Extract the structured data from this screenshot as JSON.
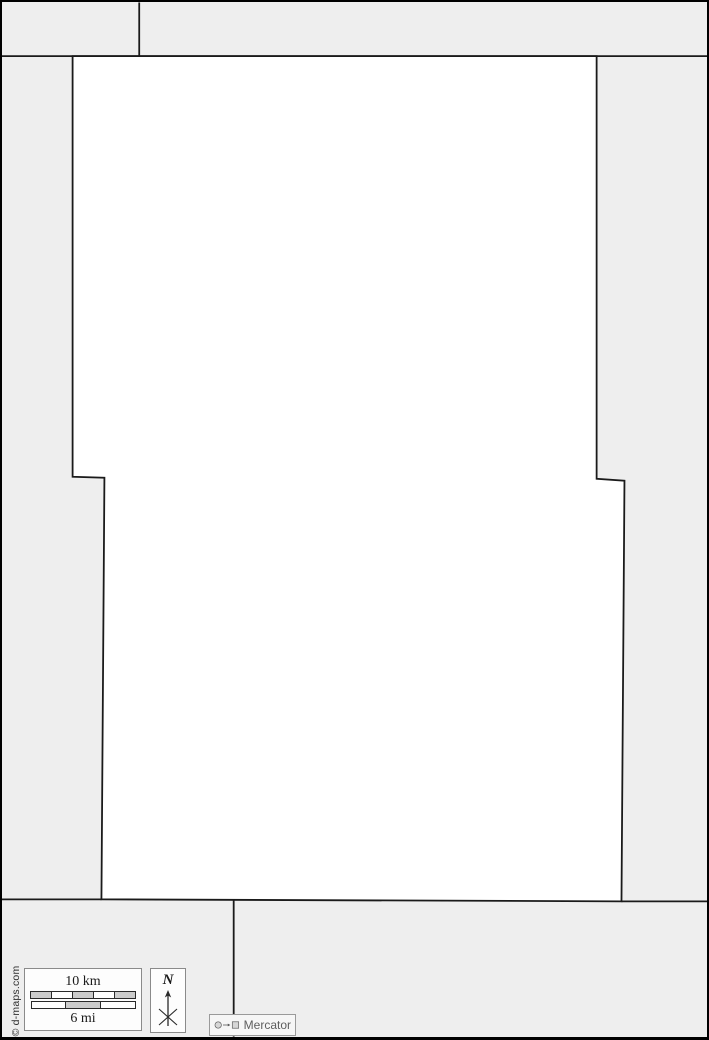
{
  "page": {
    "background_color": "#eeeeee",
    "region_fill": "#ffffff",
    "boundary_color": "#1a1a1a",
    "bar_gray": "#cccccc",
    "bar_white": "#ffffff"
  },
  "map": {
    "region_polygon": [
      [
        71,
        54
      ],
      [
        598,
        54
      ],
      [
        598,
        479
      ],
      [
        626,
        481
      ],
      [
        623,
        904
      ],
      [
        100,
        902
      ],
      [
        103,
        478
      ],
      [
        71,
        477
      ]
    ],
    "boundary_lines": [
      [
        [
          0,
          54
        ],
        [
          709,
          54
        ]
      ],
      [
        [
          138,
          0
        ],
        [
          138,
          54
        ]
      ],
      [
        [
          0,
          902
        ],
        [
          100,
          902
        ]
      ],
      [
        [
          623,
          904
        ],
        [
          709,
          904
        ]
      ],
      [
        [
          233,
          902
        ],
        [
          233,
          1040
        ]
      ]
    ]
  },
  "legend": {
    "scale": {
      "km_label": "10 km",
      "mi_label": "6 mi",
      "km_segments": [
        "#cccccc",
        "#ffffff",
        "#cccccc",
        "#ffffff",
        "#cccccc"
      ],
      "mi_segments": [
        "#ffffff",
        "#cccccc",
        "#ffffff"
      ]
    },
    "north": {
      "label": "N"
    },
    "projection": {
      "label": "Mercator"
    }
  },
  "copyright": "© d-maps.com"
}
